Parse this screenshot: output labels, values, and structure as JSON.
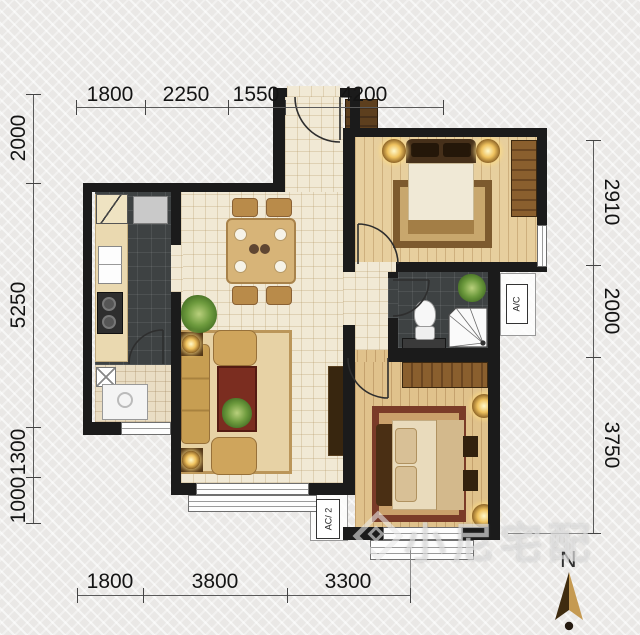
{
  "dimensions": {
    "top": [
      "1800",
      "2250",
      "1550",
      "4200"
    ],
    "bottom": [
      "1800",
      "3800",
      "3300"
    ],
    "left": [
      "2000",
      "5250",
      "1300",
      "1000"
    ],
    "right": [
      "2910",
      "2000",
      "3750"
    ]
  },
  "labels": {
    "ac_unit_right": "A/C",
    "ac_unit_bottom": "AC/ 2"
  },
  "compass": {
    "north_label": "N"
  },
  "watermark": {
    "text": "小尼宅配"
  },
  "colors": {
    "wall": "#1b1b1b",
    "light_tile_floor": "#f1e9d5",
    "dark_tile_floor": "#3e4243",
    "wood_floor": "#e7cf9e",
    "compass_gold": "#c59a52",
    "compass_dark": "#3f2c10"
  }
}
